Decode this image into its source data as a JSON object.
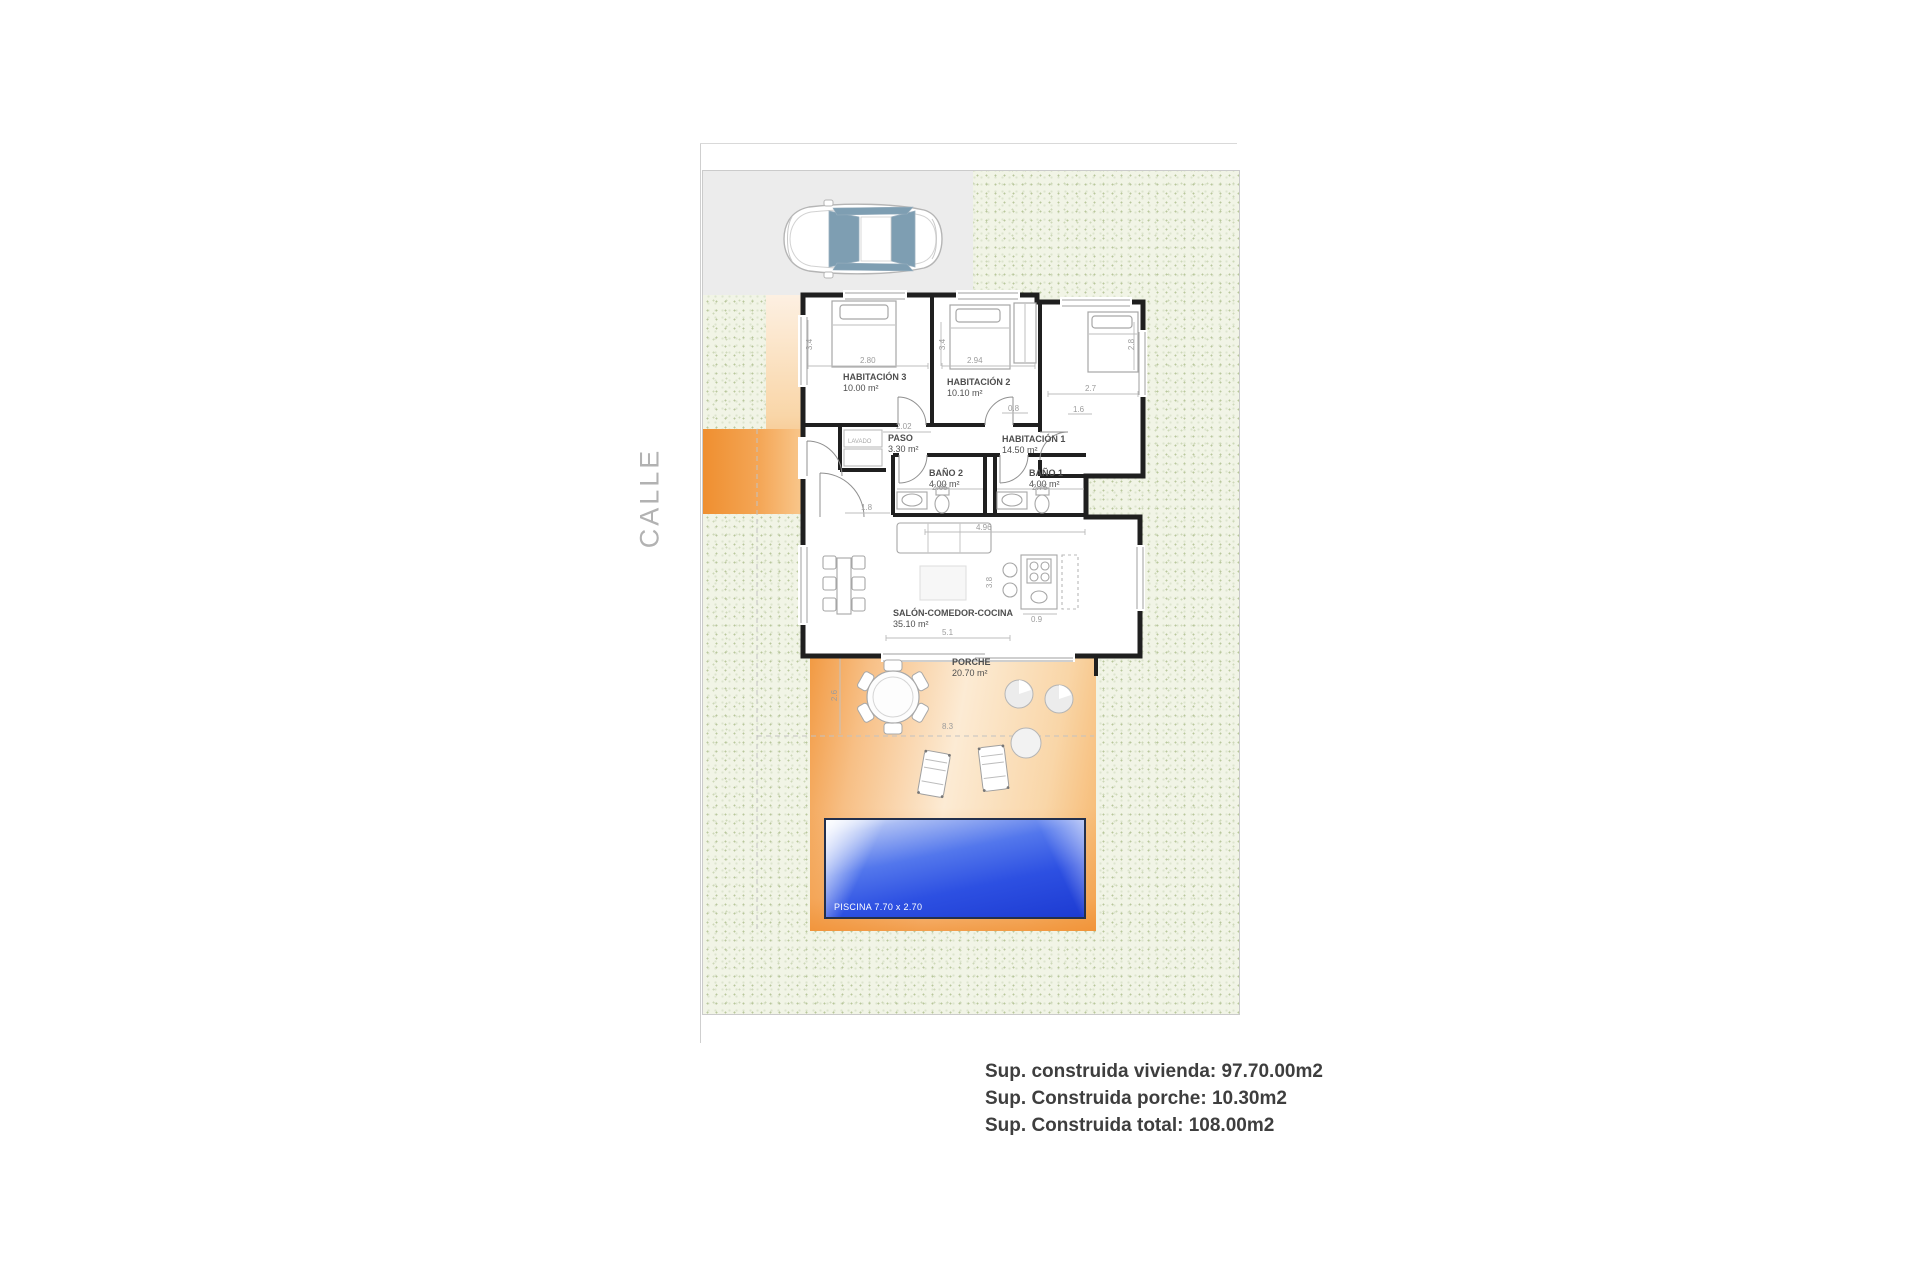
{
  "street_label": "CALLE",
  "rooms": [
    {
      "name": "HABITACIÓN 3",
      "area": "10.00 m²"
    },
    {
      "name": "HABITACIÓN 2",
      "area": "10.10 m²"
    },
    {
      "name": "HABITACIÓN 1",
      "area": "14.50 m²"
    },
    {
      "name": "PASO",
      "area": "3.30 m²"
    },
    {
      "name": "BAÑO 2",
      "area": "4.00 m²"
    },
    {
      "name": "BAÑO 1",
      "area": "4.00 m²"
    },
    {
      "name": "SALÓN-COMEDOR-COCINA",
      "area": "35.10 m²"
    },
    {
      "name": "PORCHE",
      "area": "20.70 m²"
    }
  ],
  "pool": {
    "label": "PISCINA 7.70 x 2.70"
  },
  "laundry_label": "LAVADO",
  "dims": {
    "hab3_w": "2.80",
    "hab3_d": "3.4",
    "hab2_w": "2.94",
    "hab2_d": "3.4",
    "hab1_w": "2.7",
    "hab1_d": "2.8",
    "paso_w": "2.02",
    "pass_08": "0.8",
    "pass_16": "1.6",
    "bano2_w": "2.65",
    "bano1_w": "2.75",
    "entry_w": "1.8",
    "salon_w1": "4.96",
    "salon_w2": "5.1",
    "island_w": "0.9",
    "salon_d": "3.8",
    "porch_d": "2.6",
    "porch_w": "8.3"
  },
  "summary": {
    "lines": [
      "Sup. construida vivienda: 97.70.00m2",
      "Sup. Construida porche: 10.30m2",
      "Sup. Construida total: 108.00m2"
    ]
  },
  "colors": {
    "garden": "#f1f4e6",
    "driveway": "#ececec",
    "porch_orange": "#f29a43",
    "pool_blue": "#2348e0",
    "wall": "#1f1f1f",
    "text": "#3e3e3e"
  }
}
